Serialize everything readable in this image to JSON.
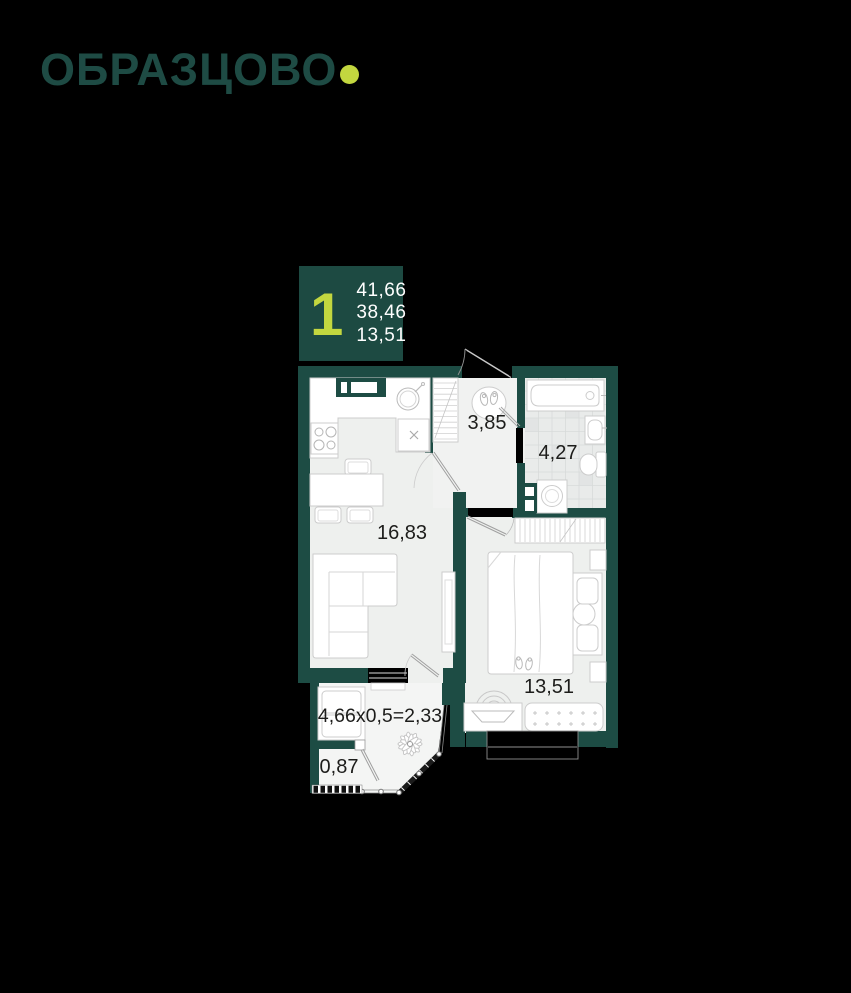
{
  "logo": {
    "text": "ОБРАЗЦОВО"
  },
  "unit_card": {
    "rooms_count": "1",
    "areas": [
      "41,66",
      "38,46",
      "13,51"
    ]
  },
  "floor_plan": {
    "rooms": {
      "kitchen_living": {
        "area": "16,83"
      },
      "hallway": {
        "area": "3,85"
      },
      "bathroom": {
        "area": "4,27"
      },
      "bedroom": {
        "area": "13,51"
      },
      "balcony": {
        "area": "4,66x0,5=2,33"
      },
      "balcony_small": {
        "area": "0,87"
      }
    },
    "icons": [
      "bathtub-icon",
      "bath-sink-icon",
      "toilet-icon",
      "washing-machine-icon",
      "stove-icon",
      "kitchen-sink-icon",
      "round-sink-icon",
      "dining-table-icon",
      "sofa-icon",
      "tv-cabinet-icon",
      "wardrobe-icon",
      "hall-wardrobe-icon",
      "rug-shoes-icon",
      "bed-icon",
      "nightstand-icon",
      "slippers-icon",
      "armchair-icon",
      "desk-tv-icon",
      "ottoman-icon",
      "bench-icon",
      "plant-icon",
      "door-icon",
      "window-icon",
      "vent-shaft-icon"
    ]
  },
  "colors": {
    "background": "#000000",
    "wall_teal": "#1d4c44",
    "badge_bg": "#1d4a42",
    "logo_teal": "#1e4b44",
    "accent_lime": "#c3d73f",
    "floor": "#eef0ee",
    "hall_floor": "#f1f2f1",
    "balcony_floor": "#f4f5f4",
    "bath_tile": "#e9ebea",
    "label_text": "#1d1d1b",
    "areas_text": "#ffffff"
  }
}
